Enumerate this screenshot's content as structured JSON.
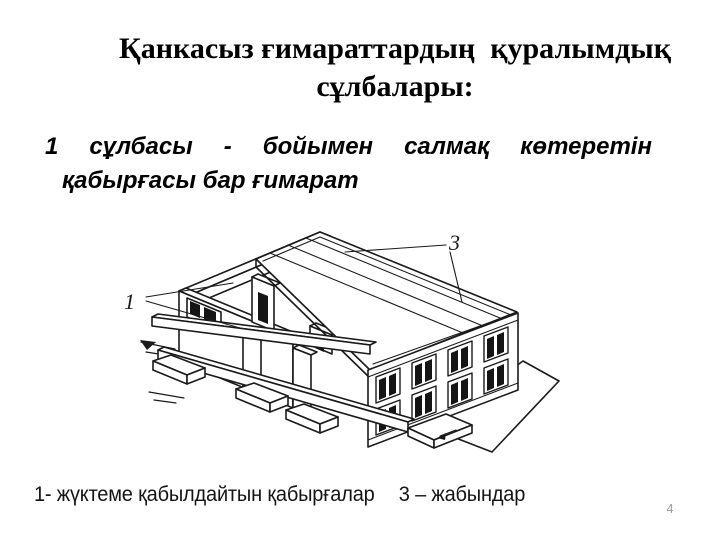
{
  "slide": {
    "background_color": "#ffffff",
    "title": {
      "line1": "Қанкасыз ғимараттардың  қуралымдық",
      "line2": "сұлбалары:"
    },
    "body": {
      "line1_words": [
        "1",
        "сұлбасы",
        "-",
        "бойымен",
        "салмақ",
        "көтеретін"
      ],
      "line2": "қабырғасы бар ғимарат"
    },
    "figure": {
      "labels": {
        "walls": "1",
        "slabs": "3"
      }
    },
    "caption": {
      "part1": "1- жүктеме қабылдайтын қабырғалар",
      "part2": "3 – жабындар"
    },
    "page_number": "4",
    "colors": {
      "text": "#000000",
      "drawing_line": "#1a1a1a",
      "page_number": "#999999"
    }
  }
}
